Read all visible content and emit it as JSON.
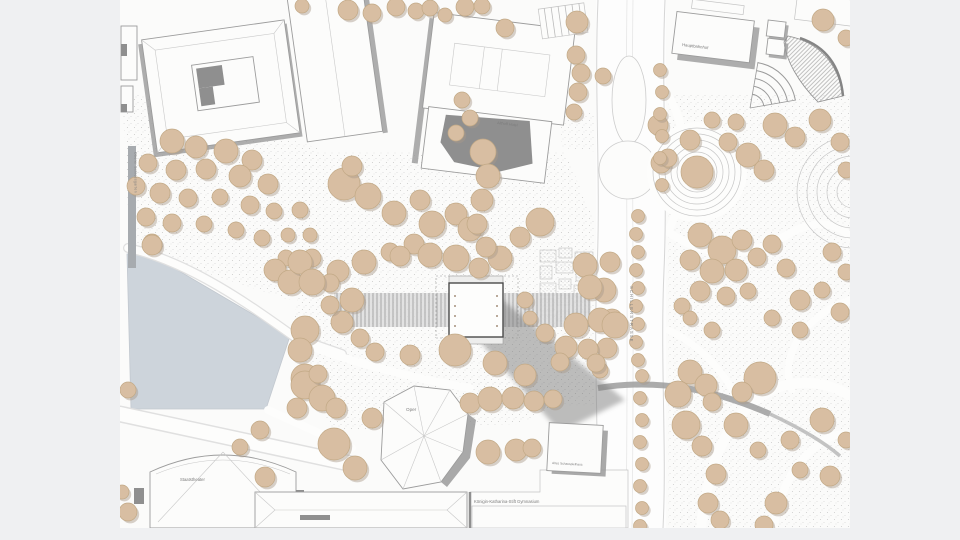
{
  "page": {
    "background": "#eff0f2",
    "plan_background": "#fbfbfa"
  },
  "colors": {
    "water": "#cdd4db",
    "tree_fill": "#d8bea2",
    "tree_stroke": "#c2a986",
    "tree_shadow": "#a89a89",
    "building_fill": "#fcfcfb",
    "building_stroke": "#9c9c9c",
    "shadow": "#9a9a9a",
    "ground_dot": "#c4c4c4",
    "road_edge": "#d5d5d5",
    "label": "#7d7d7d"
  },
  "labels": {
    "hauptbahnhof": "Hauptbahnhof",
    "hotel": "Althoff Hotel",
    "street": "SCHILLERSTRASSE",
    "opera": "Oper",
    "theater": "Staatstheater",
    "schauspielhaus": "Altes Schauspielhaus",
    "gymnasium": "Königin-Katharina-Stift Gymnasium",
    "park_vertical": "Oberer Schlossgarten"
  },
  "map": {
    "type": "site-plan",
    "trees": [
      [
        172,
        141,
        12
      ],
      [
        196,
        147,
        11
      ],
      [
        226,
        151,
        12
      ],
      [
        252,
        160,
        10
      ],
      [
        148,
        163,
        9
      ],
      [
        176,
        170,
        10
      ],
      [
        206,
        169,
        10
      ],
      [
        240,
        176,
        11
      ],
      [
        268,
        184,
        10
      ],
      [
        136,
        186,
        9
      ],
      [
        160,
        193,
        10
      ],
      [
        188,
        198,
        9
      ],
      [
        220,
        197,
        8
      ],
      [
        250,
        205,
        9
      ],
      [
        274,
        211,
        8
      ],
      [
        146,
        217,
        9
      ],
      [
        172,
        223,
        9
      ],
      [
        204,
        224,
        8
      ],
      [
        236,
        230,
        8
      ],
      [
        262,
        238,
        8
      ],
      [
        288,
        235,
        7
      ],
      [
        300,
        210,
        8
      ],
      [
        152,
        243,
        9
      ],
      [
        286,
        258,
        8
      ],
      [
        310,
        235,
        7
      ],
      [
        348,
        10,
        10
      ],
      [
        372,
        13,
        9
      ],
      [
        396,
        7,
        9
      ],
      [
        416,
        11,
        8
      ],
      [
        302,
        6,
        7
      ],
      [
        430,
        8,
        8
      ],
      [
        445,
        15,
        7
      ],
      [
        465,
        7,
        9
      ],
      [
        482,
        6,
        8
      ],
      [
        505,
        28,
        9
      ],
      [
        344,
        184,
        16
      ],
      [
        368,
        196,
        13
      ],
      [
        352,
        166,
        10
      ],
      [
        394,
        213,
        12
      ],
      [
        420,
        200,
        10
      ],
      [
        432,
        224,
        13
      ],
      [
        456,
        214,
        11
      ],
      [
        470,
        229,
        12
      ],
      [
        414,
        244,
        10
      ],
      [
        390,
        252,
        9
      ],
      [
        364,
        262,
        12
      ],
      [
        338,
        271,
        11
      ],
      [
        312,
        258,
        9
      ],
      [
        330,
        283,
        9
      ],
      [
        352,
        300,
        12
      ],
      [
        342,
        322,
        11
      ],
      [
        360,
        338,
        9
      ],
      [
        400,
        256,
        10
      ],
      [
        430,
        255,
        12
      ],
      [
        456,
        258,
        13
      ],
      [
        500,
        258,
        12
      ],
      [
        540,
        222,
        14
      ],
      [
        520,
        237,
        10
      ],
      [
        330,
        305,
        9
      ],
      [
        483,
        152,
        13
      ],
      [
        488,
        176,
        12
      ],
      [
        482,
        200,
        11
      ],
      [
        477,
        224,
        10
      ],
      [
        486,
        247,
        10
      ],
      [
        479,
        268,
        10
      ],
      [
        577,
        22,
        11
      ],
      [
        576,
        55,
        9
      ],
      [
        581,
        73,
        9
      ],
      [
        578,
        92,
        9
      ],
      [
        574,
        112,
        8
      ],
      [
        462,
        100,
        8
      ],
      [
        470,
        118,
        8
      ],
      [
        456,
        133,
        8
      ],
      [
        658,
        125,
        10
      ],
      [
        661,
        163,
        10
      ],
      [
        603,
        76,
        8
      ],
      [
        610,
        262,
        10
      ],
      [
        604,
        290,
        12
      ],
      [
        612,
        320,
        11
      ],
      [
        607,
        348,
        10
      ],
      [
        600,
        370,
        8
      ],
      [
        585,
        265,
        12
      ],
      [
        590,
        287,
        12
      ],
      [
        576,
        325,
        12
      ],
      [
        600,
        320,
        12
      ],
      [
        615,
        325,
        13
      ],
      [
        566,
        347,
        11
      ],
      [
        588,
        349,
        10
      ],
      [
        596,
        363,
        9
      ],
      [
        560,
        362,
        9
      ],
      [
        545,
        333,
        9
      ],
      [
        525,
        300,
        8
      ],
      [
        530,
        318,
        7
      ],
      [
        455,
        350,
        16
      ],
      [
        495,
        363,
        12
      ],
      [
        525,
        375,
        11
      ],
      [
        410,
        355,
        10
      ],
      [
        375,
        352,
        9
      ],
      [
        372,
        418,
        10
      ],
      [
        152,
        245,
        10
      ],
      [
        275,
        270,
        11
      ],
      [
        290,
        282,
        12
      ],
      [
        300,
        262,
        12
      ],
      [
        312,
        282,
        13
      ],
      [
        305,
        330,
        14
      ],
      [
        300,
        350,
        12
      ],
      [
        305,
        378,
        14
      ],
      [
        265,
        477,
        10
      ],
      [
        128,
        390,
        8
      ],
      [
        122,
        492,
        7
      ],
      [
        128,
        512,
        9
      ],
      [
        305,
        385,
        14
      ],
      [
        322,
        398,
        13
      ],
      [
        297,
        408,
        10
      ],
      [
        318,
        374,
        9
      ],
      [
        336,
        408,
        10
      ],
      [
        334,
        444,
        16
      ],
      [
        355,
        468,
        12
      ],
      [
        260,
        430,
        9
      ],
      [
        240,
        447,
        8
      ],
      [
        470,
        403,
        10
      ],
      [
        490,
        399,
        12
      ],
      [
        513,
        398,
        11
      ],
      [
        534,
        401,
        10
      ],
      [
        553,
        399,
        9
      ],
      [
        488,
        452,
        12
      ],
      [
        516,
        450,
        11
      ],
      [
        532,
        448,
        9
      ],
      [
        697,
        172,
        16
      ],
      [
        690,
        140,
        10
      ],
      [
        668,
        158,
        9
      ],
      [
        728,
        142,
        9
      ],
      [
        748,
        155,
        12
      ],
      [
        764,
        170,
        10
      ],
      [
        736,
        122,
        8
      ],
      [
        712,
        120,
        8
      ],
      [
        823,
        20,
        11
      ],
      [
        846,
        38,
        8
      ],
      [
        775,
        125,
        12
      ],
      [
        795,
        137,
        10
      ],
      [
        820,
        120,
        11
      ],
      [
        840,
        142,
        9
      ],
      [
        846,
        170,
        8
      ],
      [
        700,
        235,
        12
      ],
      [
        722,
        250,
        14
      ],
      [
        742,
        240,
        10
      ],
      [
        712,
        271,
        12
      ],
      [
        690,
        260,
        10
      ],
      [
        736,
        270,
        11
      ],
      [
        757,
        257,
        9
      ],
      [
        772,
        244,
        9
      ],
      [
        700,
        291,
        10
      ],
      [
        726,
        296,
        9
      ],
      [
        682,
        306,
        8
      ],
      [
        748,
        291,
        8
      ],
      [
        800,
        300,
        10
      ],
      [
        822,
        290,
        8
      ],
      [
        840,
        312,
        9
      ],
      [
        832,
        252,
        9
      ],
      [
        846,
        272,
        8
      ],
      [
        786,
        268,
        9
      ],
      [
        800,
        330,
        8
      ],
      [
        772,
        318,
        8
      ],
      [
        690,
        318,
        7
      ],
      [
        712,
        330,
        8
      ],
      [
        690,
        372,
        12
      ],
      [
        706,
        385,
        11
      ],
      [
        678,
        394,
        13
      ],
      [
        712,
        402,
        9
      ],
      [
        760,
        378,
        16
      ],
      [
        742,
        392,
        10
      ],
      [
        736,
        425,
        12
      ],
      [
        686,
        425,
        14
      ],
      [
        702,
        446,
        10
      ],
      [
        716,
        474,
        10
      ],
      [
        708,
        503,
        10
      ],
      [
        776,
        503,
        11
      ],
      [
        822,
        420,
        12
      ],
      [
        830,
        476,
        10
      ],
      [
        846,
        440,
        8
      ],
      [
        790,
        440,
        9
      ],
      [
        800,
        470,
        8
      ],
      [
        758,
        450,
        8
      ],
      [
        720,
        520,
        9
      ],
      [
        764,
        525,
        9
      ]
    ],
    "street_trees": [
      [
        638,
        216
      ],
      [
        636,
        234
      ],
      [
        638,
        252
      ],
      [
        636,
        270
      ],
      [
        638,
        288
      ],
      [
        636,
        306
      ],
      [
        638,
        324
      ],
      [
        636,
        342
      ],
      [
        638,
        360
      ],
      [
        642,
        376
      ],
      [
        640,
        398
      ],
      [
        642,
        420
      ],
      [
        640,
        442
      ],
      [
        642,
        464
      ],
      [
        640,
        486
      ],
      [
        642,
        508
      ],
      [
        640,
        526
      ],
      [
        660,
        70
      ],
      [
        662,
        92
      ],
      [
        660,
        114
      ],
      [
        662,
        136
      ],
      [
        660,
        158
      ],
      [
        662,
        185
      ]
    ]
  }
}
